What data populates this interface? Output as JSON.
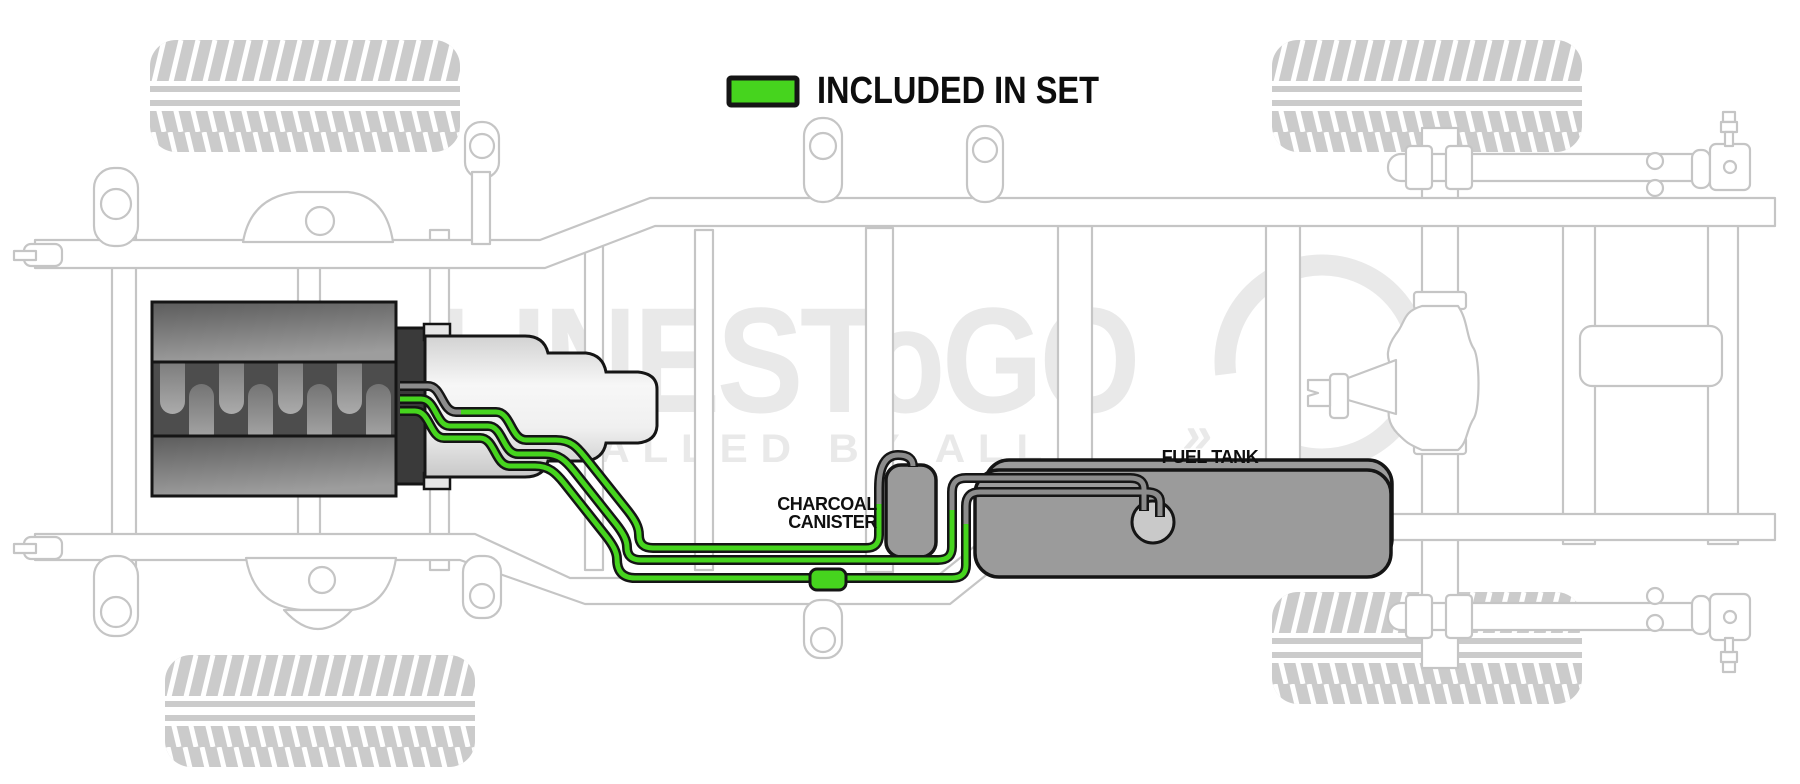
{
  "legend": {
    "label": "INCLUDED IN SET"
  },
  "canister": {
    "label_line1": "CHARCOAL",
    "label_line2": "CANISTER"
  },
  "tank": {
    "label": "FUEL TANK"
  },
  "watermark": {
    "brand": "LINESToGO",
    "tagline": "INSTALLED BY ALL",
    "mark": "»"
  },
  "colors": {
    "included_green": "#46d41e",
    "line_gray": "#8c8c8c",
    "frame_gray": "#c5c5c5",
    "watermark_gray": "#e9e9e9",
    "tank_gray": "#9b9b9b",
    "outline_black": "#151515"
  }
}
